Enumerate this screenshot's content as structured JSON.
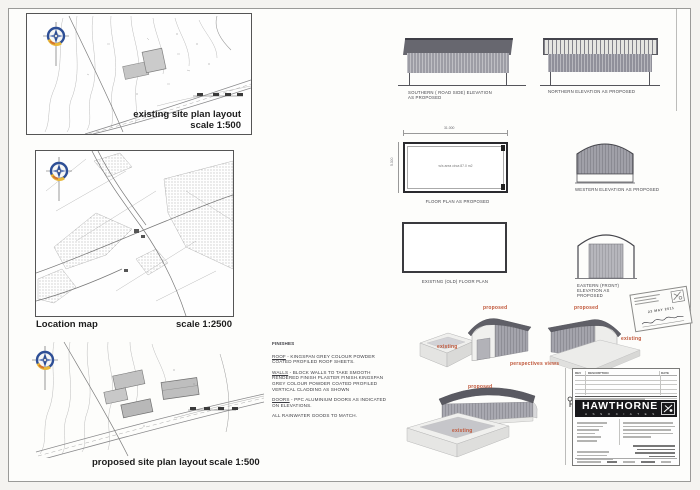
{
  "sheet": {
    "site_plans": {
      "existing": {
        "title": "existing  site plan layout",
        "scale": "scale  1:500"
      },
      "location": {
        "title": "Location map",
        "scale": "scale  1:2500"
      },
      "proposed": {
        "title": "proposed site plan layout",
        "scale": "scale  1:500"
      }
    },
    "drawings": {
      "southern": {
        "line1": "SOUTHERN ( ROAD SIDE) ELEVATION",
        "line2": "AS PROPOSED"
      },
      "northern": {
        "label": "NORTHERN ELEVATION AS PROPOSED"
      },
      "floor_plan": {
        "label": "FLOOR PLAN AS PROPOSED",
        "area_note": "w/s area circa 87.0 m2",
        "dim_top": "31.000",
        "dim_left": "5.300"
      },
      "western": {
        "label": "WESTERN ELEVATION AS PROPOSED"
      },
      "old_floor_plan": {
        "label": "EXISTING (OLD) FLOOR PLAN"
      },
      "eastern": {
        "line1": "EASTERN (FRONT) ELEVATION AS",
        "line2": "PROPOSED"
      }
    },
    "finishes": {
      "heading": "FINISHES",
      "items": [
        {
          "term": "ROOF",
          "text": " - KINGSPAN GREY COLOUR POWDER COATED PROFILED ROOF SHEETS."
        },
        {
          "term": "WALLS",
          "text": " - BLOCK WALLS TO TAKE SMOOTH RENDERED FINISH PLASTER FINISH.KINGSPAN GREY COLOUR POWDER COATED PROFILED VERTICAL CLADDING AS SHOWN"
        },
        {
          "term": "DOORS",
          "text": " - PPC ALUMINIUM DOORS AS INDICATED ON ELEVATIONS."
        }
      ],
      "footer": "ALL RAINWATER GOODS TO MATCH."
    },
    "perspectives": {
      "caption": "perspectives views",
      "top_left": "existing",
      "top_mid": "proposed",
      "top_right": "proposed",
      "far_right": "existing",
      "bottom_building": "proposed",
      "bottom_pit": "existing",
      "label_color": "#c0573a"
    },
    "stamp": {
      "date": "23 MAY 2011"
    },
    "title_block": {
      "company": "HAWTHORNE",
      "subtitle": "A S S O C I A T E S",
      "rev": {
        "c1": "REV",
        "c2": "DESCRIPTION",
        "c3": "DATE"
      }
    }
  }
}
